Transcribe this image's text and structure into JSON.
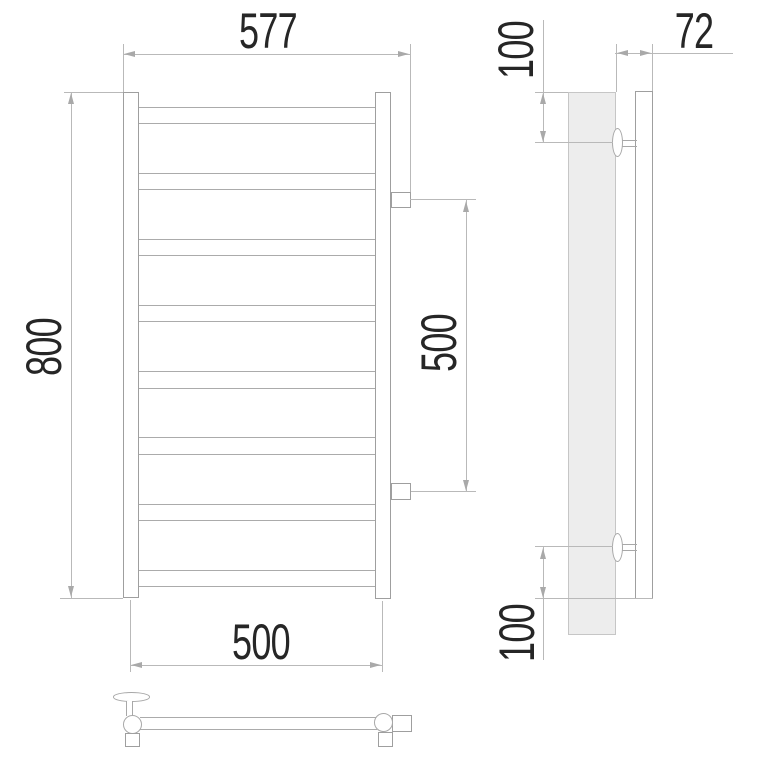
{
  "drawing": {
    "type": "technical-drawing",
    "subject": "ladder-style heated towel rail, three orthographic views",
    "dimensions": {
      "front_width_overall": "577",
      "front_height_overall": "800",
      "front_connection_spacing": "500",
      "front_mount_spacing": "500",
      "side_depth": "72",
      "side_top_offset": "100",
      "side_bottom_offset": "100"
    },
    "colors": {
      "background": "#ffffff",
      "object_line": "#9f9f9f",
      "dimension_line": "#b9b9b9",
      "text": "#262626",
      "wall_fill": "#ededed"
    }
  }
}
